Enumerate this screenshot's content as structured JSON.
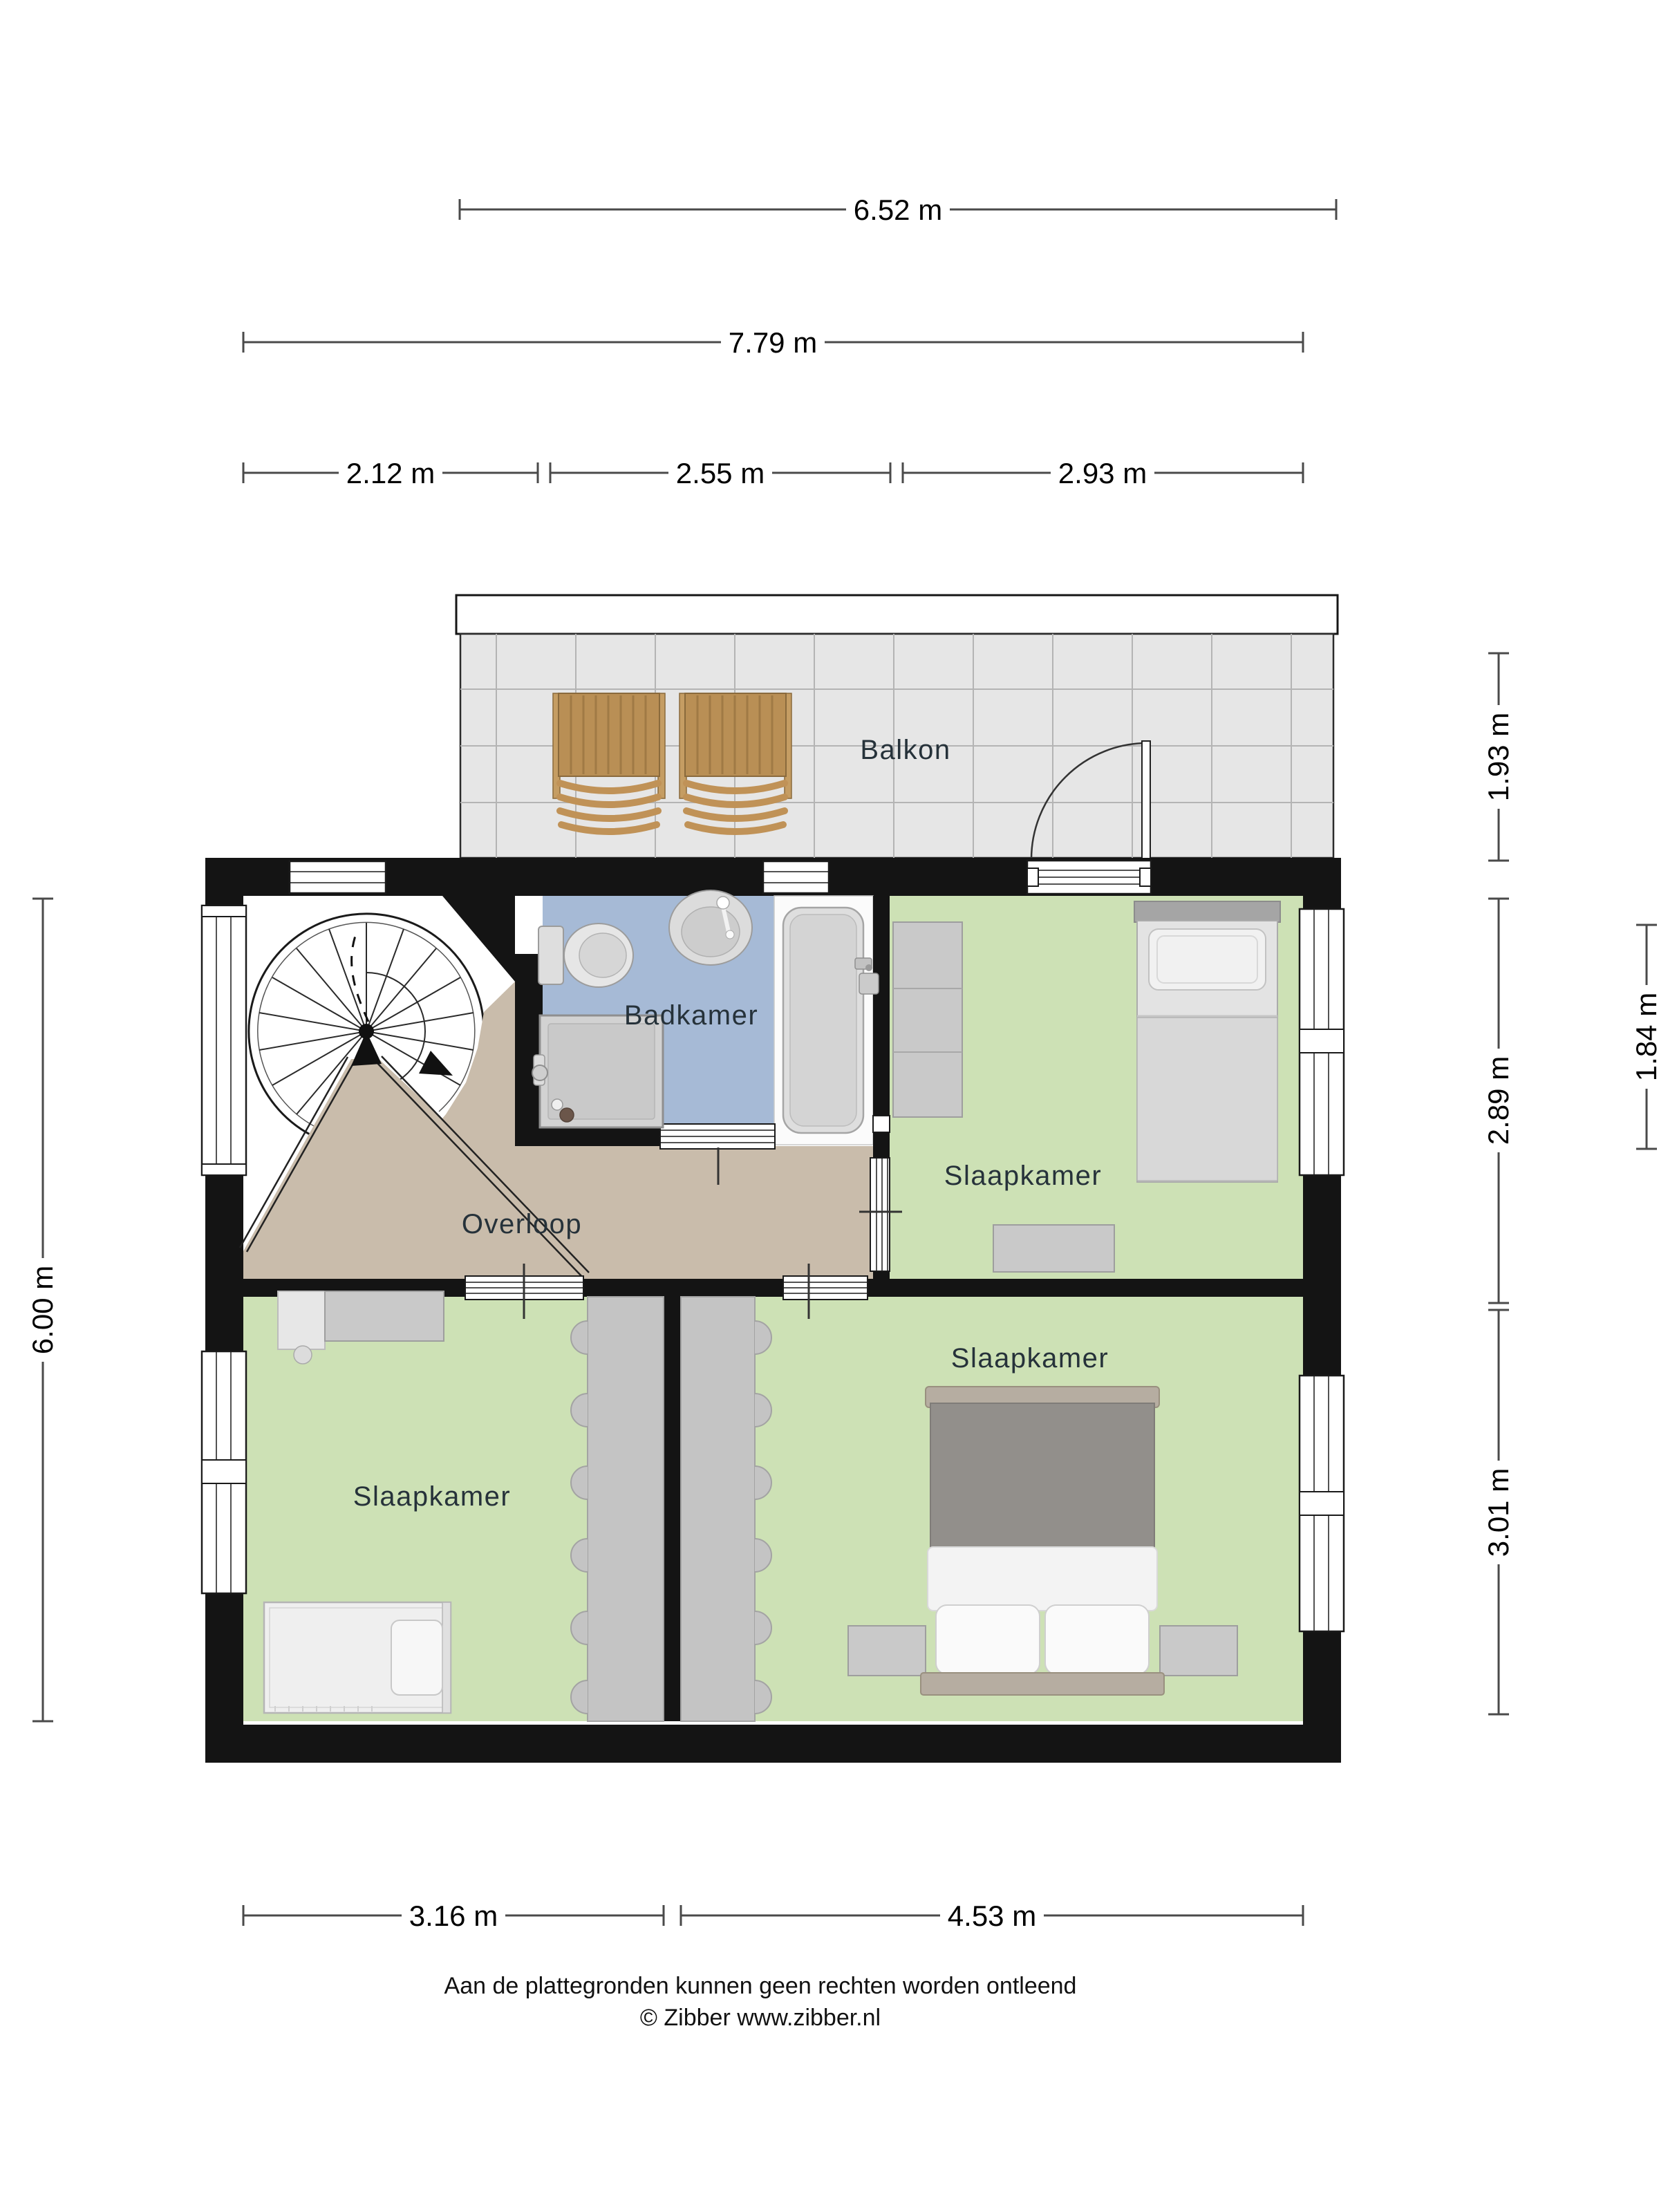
{
  "floorplan": {
    "rooms": {
      "balkon": "Balkon",
      "badkamer": "Badkamer",
      "overloop": "Overloop",
      "slaapkamer_top": "Slaapkamer",
      "slaapkamer_left": "Slaapkamer",
      "slaapkamer_right": "Slaapkamer"
    },
    "dimensions": {
      "top_balcony_width": "6.52 m",
      "top_total_width": "7.79 m",
      "top_segments": [
        "2.12 m",
        "2.55 m",
        "2.93 m"
      ],
      "right_balcony_depth": "1.93 m",
      "right_bedroom_top": "2.89 m",
      "right_bedroom_bottom": "3.01 m",
      "right_bathroom_depth": "1.84 m",
      "left_total_depth": "6.00 m",
      "bottom_left_width": "3.16 m",
      "bottom_right_width": "4.53 m"
    },
    "footer": {
      "disclaimer": "Aan de plattegronden kunnen geen rechten worden ontleend",
      "copyright": "© Zibber www.zibber.nl"
    },
    "colors": {
      "wall": "#141414",
      "bedroom_floor": "#cde1b5",
      "bathroom_floor": "#a6bad6",
      "landing_floor": "#c9bcab",
      "balcony_floor": "#e6e6e6",
      "furniture_gray": "#c9c9c9",
      "wood": "#c1975d",
      "bed_duvet": "#928f8b"
    }
  }
}
